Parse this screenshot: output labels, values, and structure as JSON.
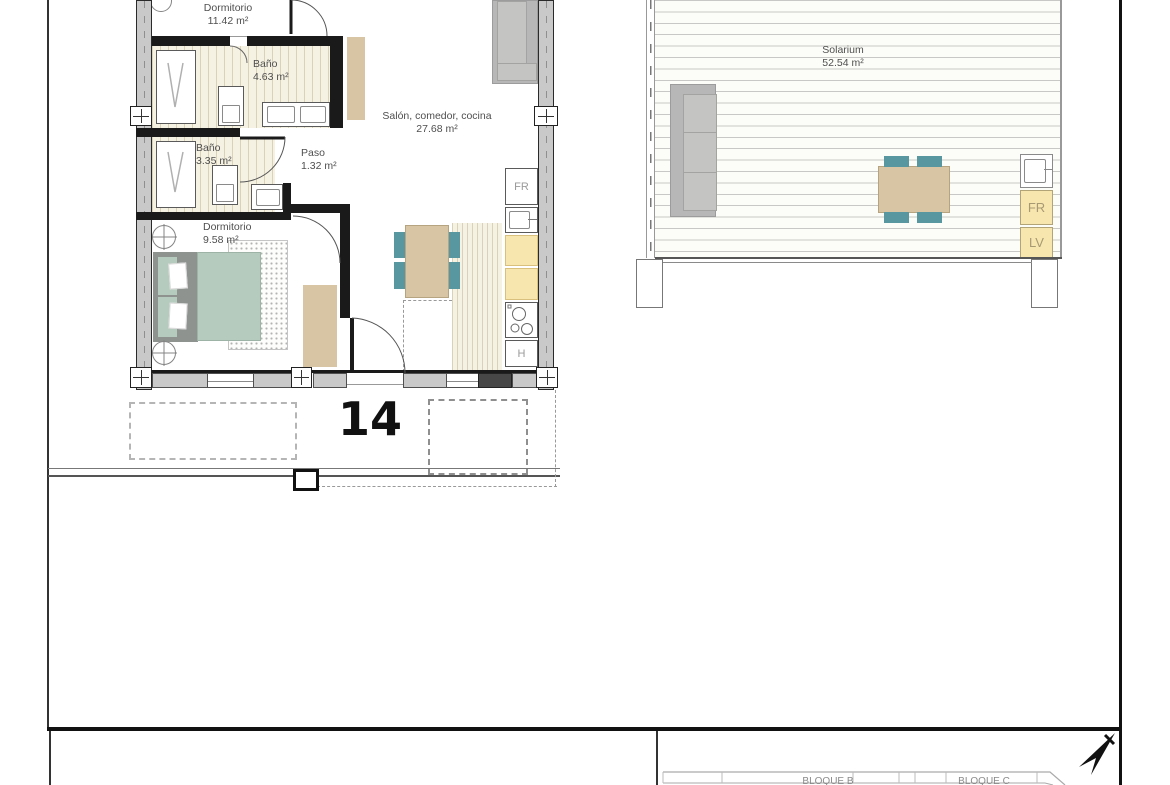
{
  "sheet": {
    "unit_number": "14",
    "apartment": {
      "rooms": [
        {
          "name": "Dormitorio",
          "area": "11.42 m²"
        },
        {
          "name": "Baño",
          "area": "4.63 m²"
        },
        {
          "name": "Salón, comedor, cocina",
          "area": "27.68 m²"
        },
        {
          "name": "Baño",
          "area": "3.35 m²"
        },
        {
          "name": "Paso",
          "area": "1.32 m²"
        },
        {
          "name": "Dormitorio",
          "area": "9.58 m²"
        }
      ],
      "appliance_labels": {
        "fridge": "FR",
        "oven": "H"
      }
    },
    "solarium": {
      "room": {
        "name": "Solarium",
        "area": "52.54 m²"
      },
      "appliance_labels": {
        "fridge": "FR",
        "dishwasher": "LV"
      }
    },
    "title_block": {
      "block_b": "BLOQUE B",
      "block_c": "BLOQUE C"
    }
  },
  "colors": {
    "wall-dark": "#1a1a1a",
    "wall-fill": "#c9c9c9",
    "floor-bg": "#f6f2e3",
    "floor-line": "#d9d2ba",
    "tan": "#d7c5a4",
    "sage": "#b4cbbd",
    "headboard": "#8e9390",
    "teal": "#5897a0",
    "cabinet-yellow": "#f8e6af",
    "cabinet-border": "#d9c07c",
    "sofa": "#b7b7b7",
    "label-text": "#4f4f4f",
    "appliance-text": "#9a9a9a",
    "sol-appliance-text": "#a79a72"
  }
}
